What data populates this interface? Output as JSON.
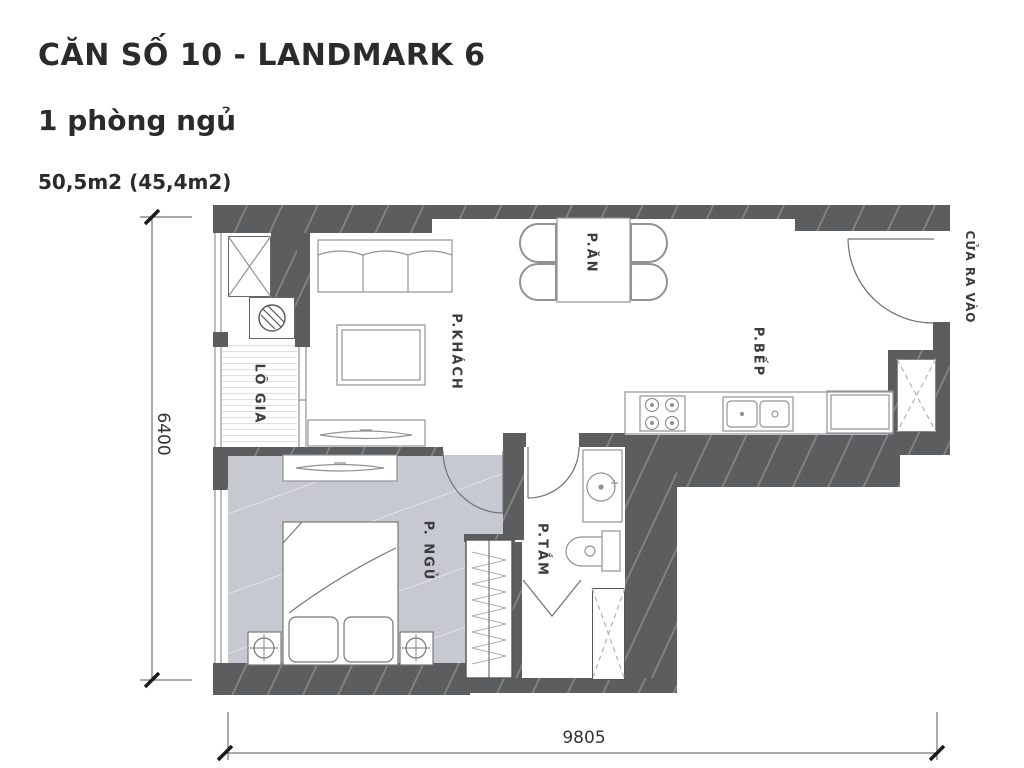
{
  "header": {
    "title": "CĂN SỐ 10 - LANDMARK 6",
    "subtitle": "1 phòng ngủ",
    "area": "50,5m2 (45,4m2)"
  },
  "plan": {
    "rooms": {
      "living": "P.KHÁCH",
      "dining": "P.ĂN",
      "kitchen": "P.BẾP",
      "loggia": "LÔ GIA",
      "bedroom": "P. NGỦ",
      "bathroom": "P.TẮM",
      "entrance": "CỬA RA VÀO"
    },
    "dimensions": {
      "horizontal": "9805",
      "vertical": "6400"
    },
    "colors": {
      "wall": "#5c5d5e",
      "bedroom_floor": "#c6c9cf",
      "line": "#8f9398"
    }
  }
}
